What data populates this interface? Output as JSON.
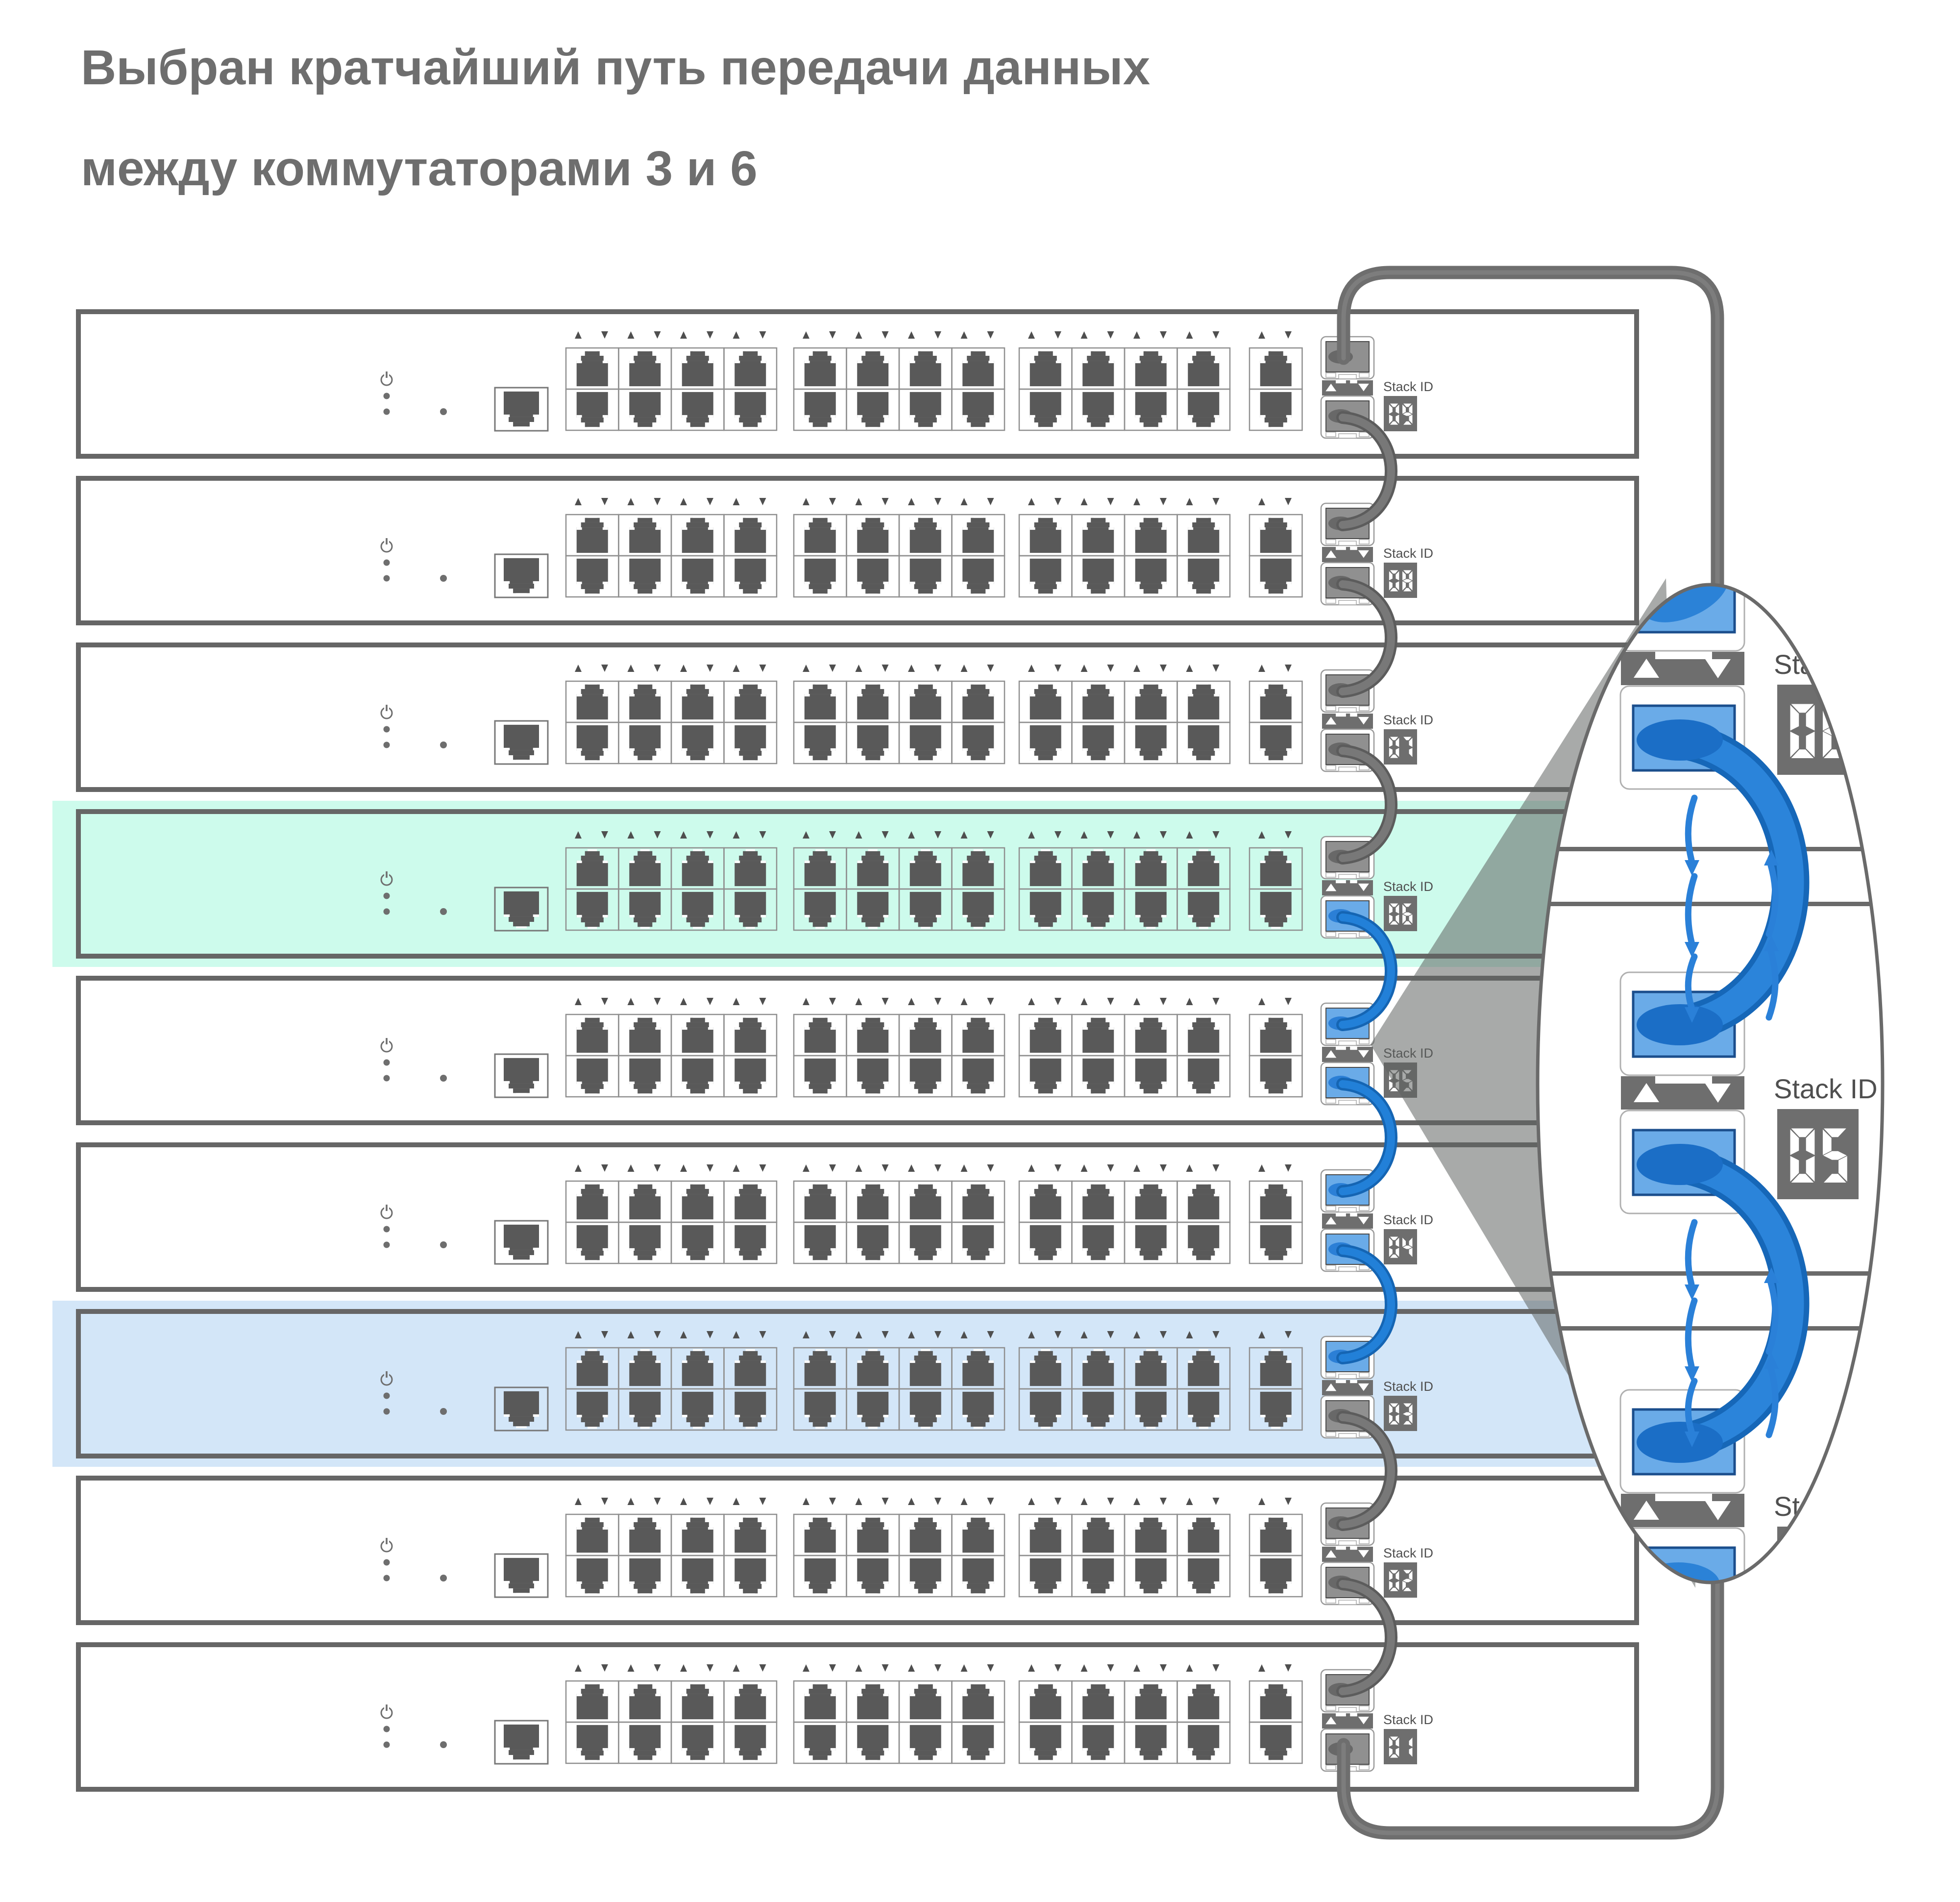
{
  "title": {
    "line1": "Выбран кратчайший путь передачи данных",
    "line2": "между коммутаторами 3 и 6"
  },
  "stack": {
    "stack_id_label": "Stack ID",
    "switches": [
      {
        "stack_id": "09",
        "highlight": null,
        "sfp": [
          "gray",
          "gray"
        ]
      },
      {
        "stack_id": "08",
        "highlight": null,
        "sfp": [
          "gray",
          "gray"
        ]
      },
      {
        "stack_id": "07",
        "highlight": null,
        "sfp": [
          "gray",
          "gray"
        ]
      },
      {
        "stack_id": "06",
        "highlight": "green",
        "sfp": [
          "gray",
          "blue"
        ]
      },
      {
        "stack_id": "05",
        "highlight": null,
        "sfp": [
          "blue",
          "blue"
        ]
      },
      {
        "stack_id": "04",
        "highlight": null,
        "sfp": [
          "blue",
          "blue"
        ]
      },
      {
        "stack_id": "03",
        "highlight": "blue",
        "sfp": [
          "blue",
          "gray"
        ]
      },
      {
        "stack_id": "02",
        "highlight": null,
        "sfp": [
          "gray",
          "gray"
        ]
      },
      {
        "stack_id": "01",
        "highlight": null,
        "sfp": [
          "gray",
          "gray"
        ]
      }
    ],
    "links": [
      "gray",
      "gray",
      "gray",
      "blue",
      "blue",
      "blue",
      "gray",
      "gray"
    ],
    "ring_link": "gray",
    "port_groups": [
      4,
      4,
      4,
      1
    ],
    "port_rows": 2
  },
  "magnifier": {
    "stack_id_label": "Stack ID",
    "switch_ids": [
      "06",
      "05",
      "04"
    ],
    "highlighted_path": [
      "06",
      "05",
      "04"
    ]
  },
  "colors": {
    "title_text": "#6e6e6e",
    "label_text": "#4f4f4f",
    "switch_border": "#666666",
    "highlight_green": "#cdfbec",
    "highlight_blue": "#d3e6f8",
    "cable_gray_dark": "#5c5c5c",
    "cable_gray": "#6e6e6e",
    "cable_blue_dark": "#1565b3",
    "cable_blue": "#2280d8",
    "sfp_gray": "#909090",
    "sfp_blue": "#6aabe8",
    "blob_gray": "#686868",
    "blob_blue": "#2b7fd6",
    "port_dark": "#595959",
    "port_outline": "#8f8f8f",
    "display_bg": "#6e6e6e",
    "display_segment": "#ffffff",
    "arrow_flow_blue": "#2a80d8",
    "wedge": "rgba(95,98,97,0.54)",
    "ellipse_border": "#6a6a6a"
  }
}
